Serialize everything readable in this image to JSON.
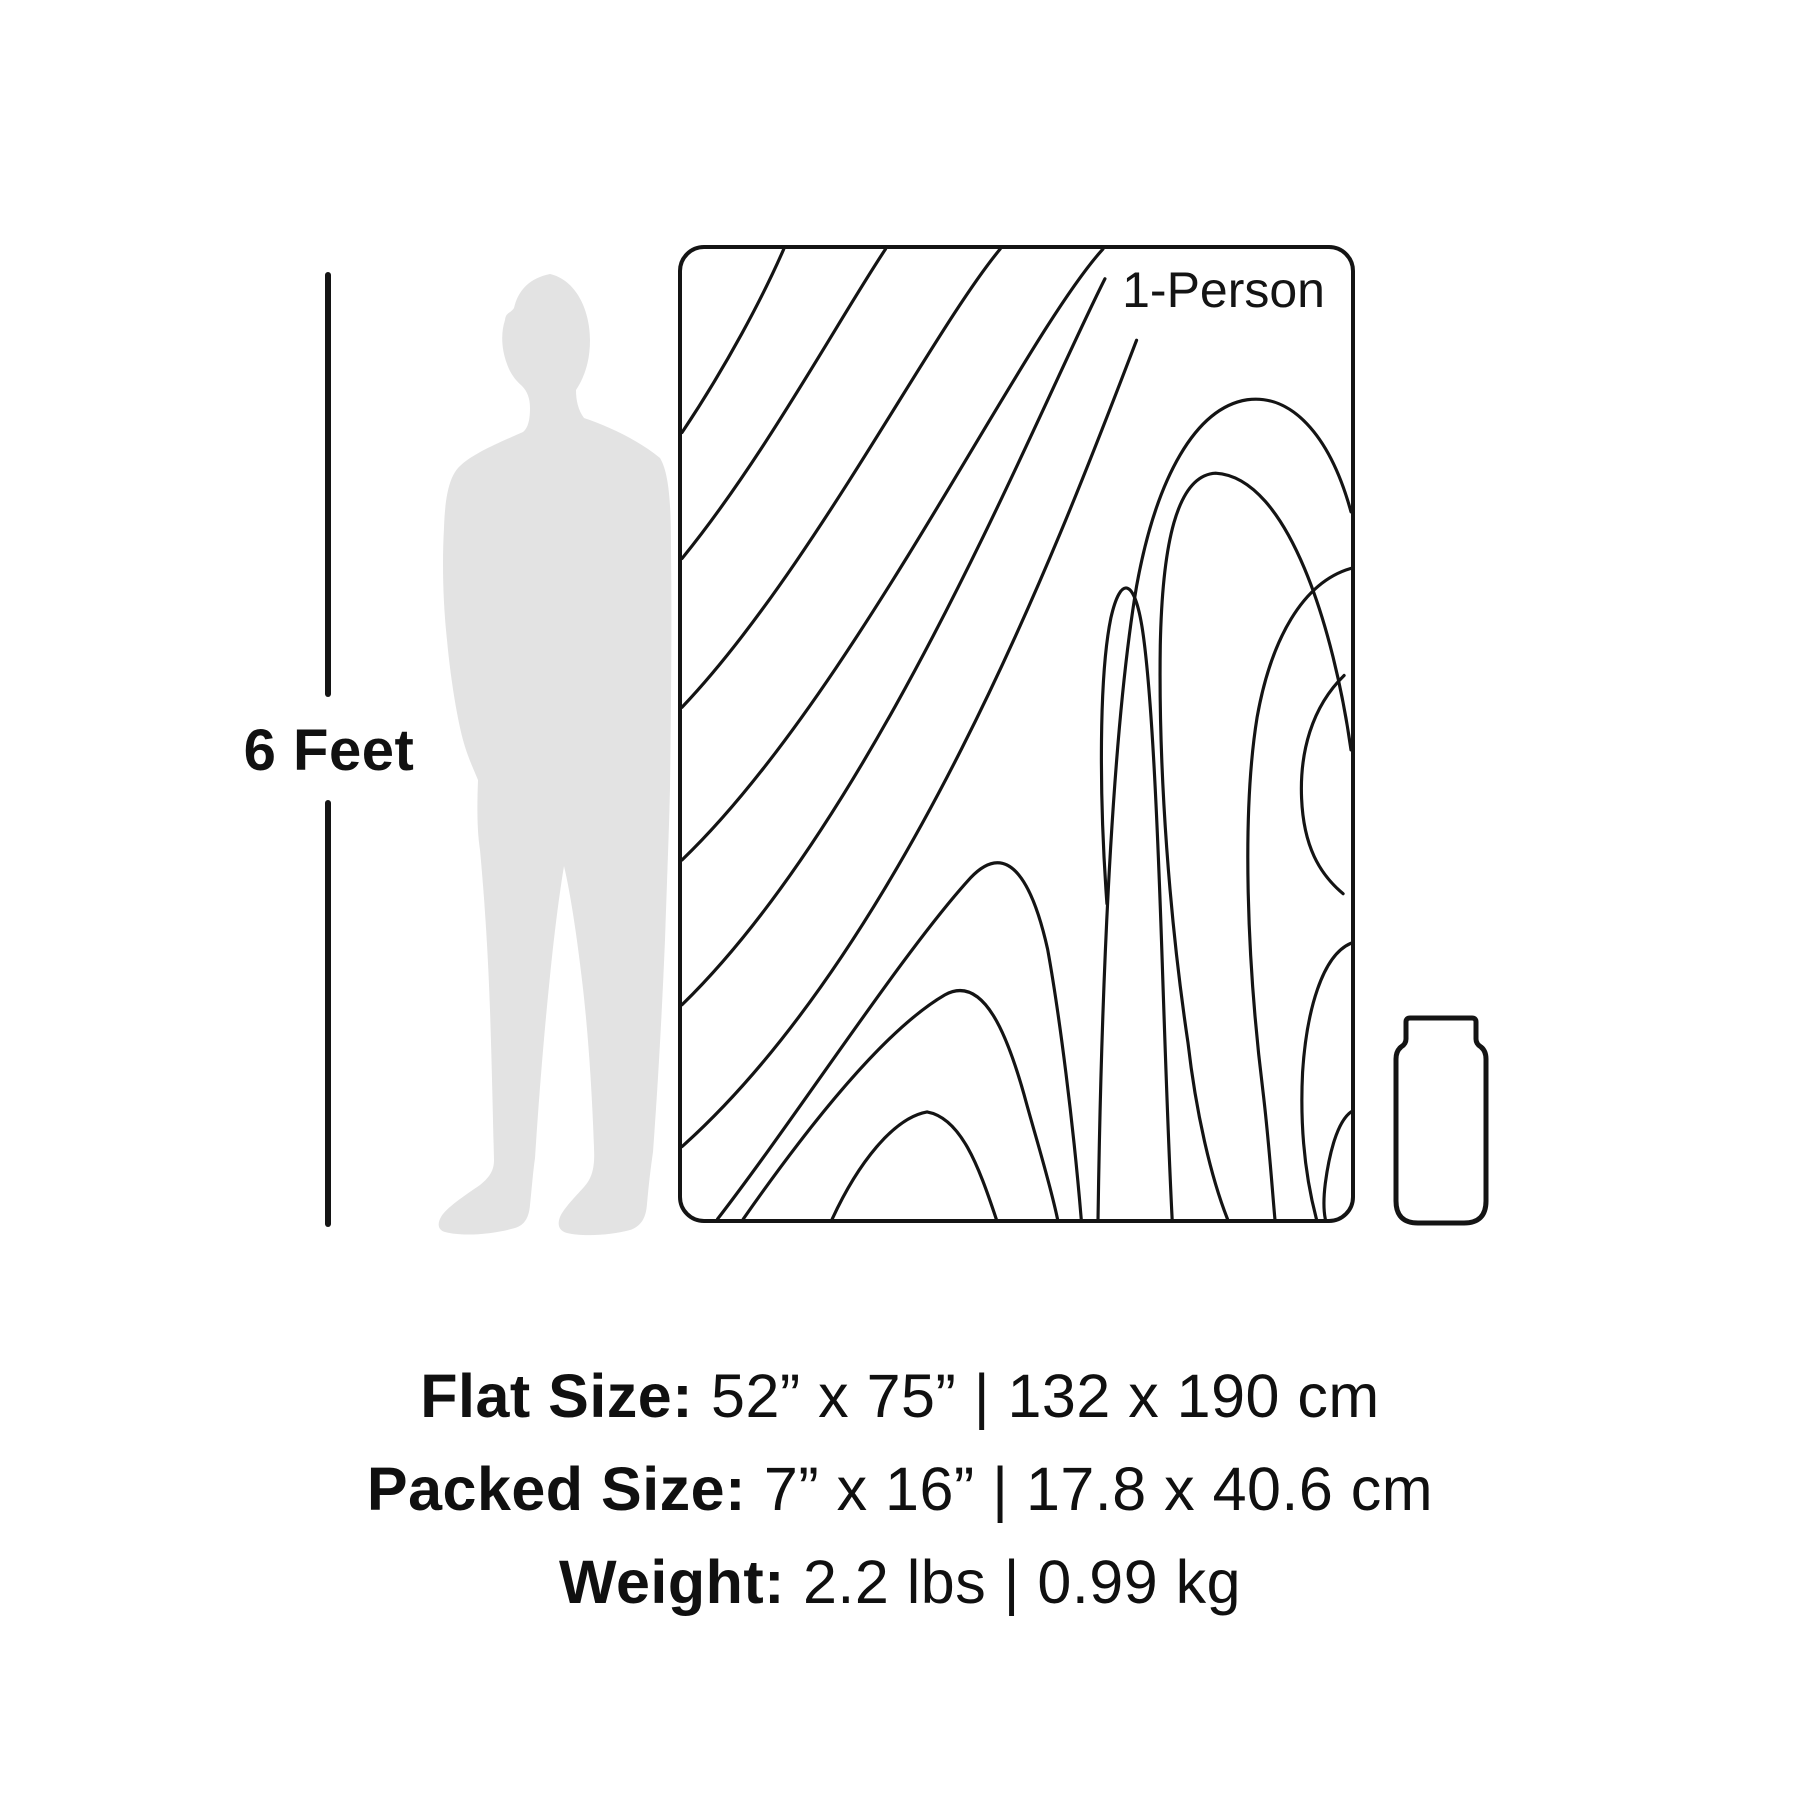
{
  "scale": {
    "label": "6 Feet"
  },
  "blanket": {
    "label": "1-Person"
  },
  "specs": {
    "flat": {
      "label": "Flat Size:",
      "value": "52” x 75” | 132 x 190 cm"
    },
    "packed": {
      "label": "Packed Size:",
      "value": "7” x 16” | 17.8 x 40.6 cm"
    },
    "weight": {
      "label": "Weight:",
      "value": "2.2 lbs | 0.99 kg"
    }
  },
  "colors": {
    "background": "#ffffff",
    "ink": "#141414",
    "silhouette": "#e3e3e3"
  },
  "icons": {
    "person": "standing-person-silhouette",
    "packed_item": "packed-stuff-sack"
  }
}
